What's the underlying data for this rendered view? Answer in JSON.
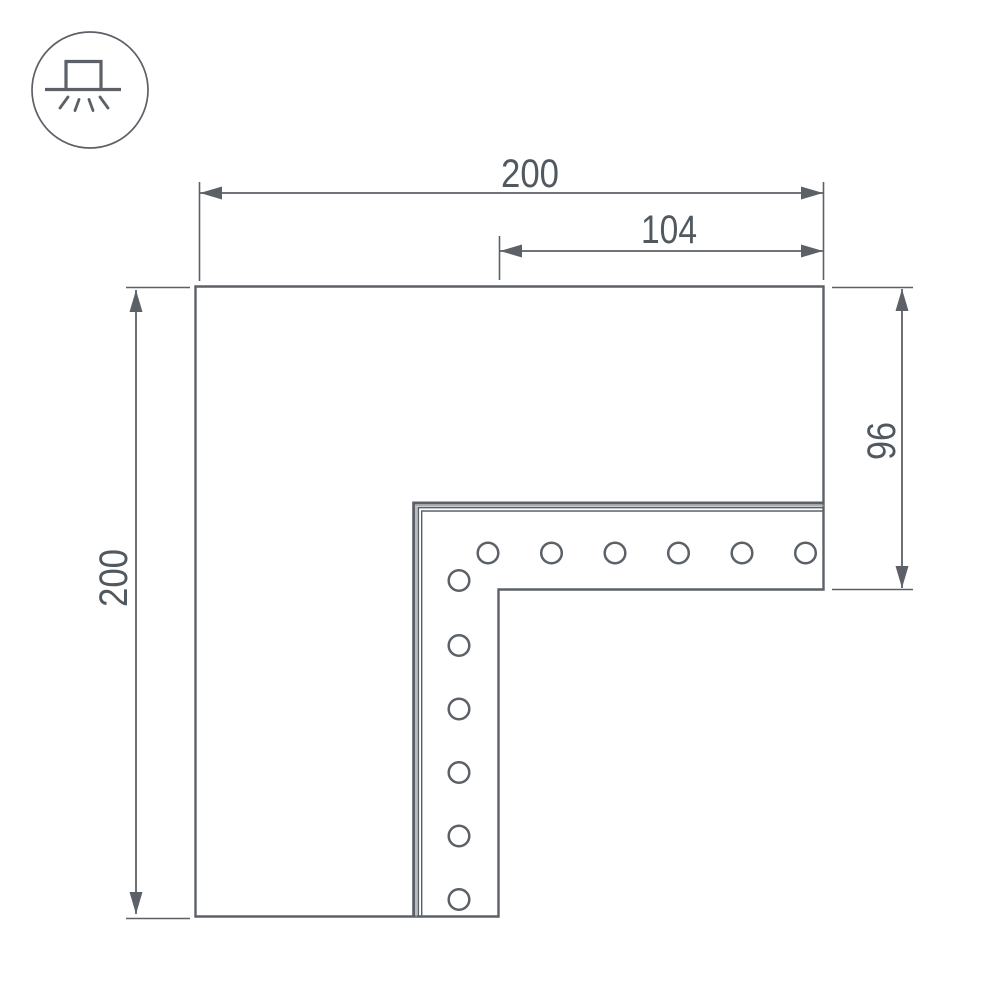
{
  "colors": {
    "line": "#5b6167",
    "line_light": "#a9aeb3",
    "text": "#515960",
    "background": "#ffffff"
  },
  "icon": {
    "name": "surface-mounted-light-icon"
  },
  "dimensions": {
    "overall_width": {
      "label": "200"
    },
    "arm_inner_width": {
      "label": "104"
    },
    "overall_height": {
      "label": "200"
    },
    "arm_height": {
      "label": "96"
    }
  },
  "shape": {
    "type": "L-shaped corner connector, top view",
    "hole_count_horizontal_row": 6,
    "hole_count_corner": 1,
    "hole_count_vertical_column": 5
  }
}
